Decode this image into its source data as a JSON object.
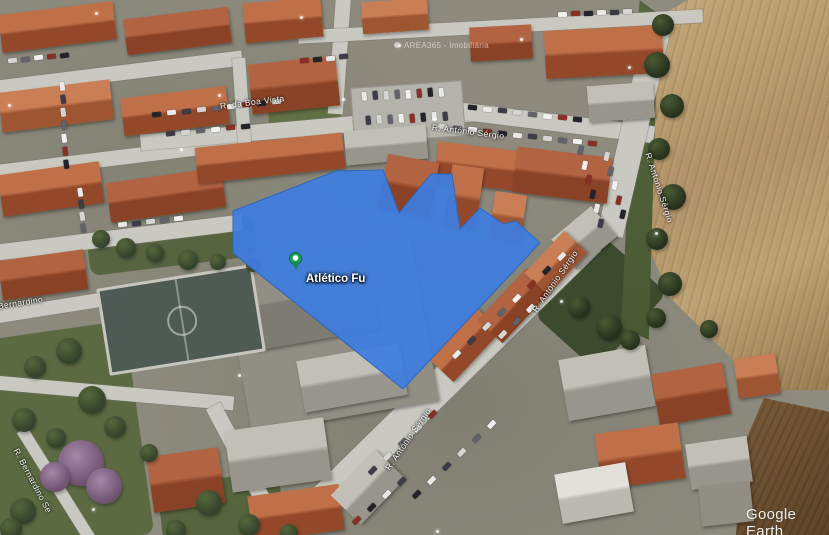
{
  "app": {
    "watermark": "Google Earth"
  },
  "attribution_label": {
    "text": "AREA365 - Imobiliária"
  },
  "marker": {
    "label": "Atlético Fu",
    "pin_color": "#1ca05f",
    "x": 296,
    "y": 272
  },
  "overlay": {
    "color": "#3d7de0",
    "stroke": "#2f66c0",
    "opacity": 0.93,
    "points": "233,211 336,171 383,170 399,213 431,174 452,174 460,229 480,208 503,224 516,221 540,243 403,389 233,253"
  },
  "street_labels": [
    {
      "text": "R. da Boa Vista",
      "x": 220,
      "y": 101,
      "rot": -7
    },
    {
      "text": "R. António Sérgio",
      "x": 432,
      "y": 122,
      "rot": 7
    },
    {
      "text": "R. António Sérgio",
      "x": 648,
      "y": 148,
      "rot": 72
    },
    {
      "text": "R. António Sérgio",
      "x": 534,
      "y": 306,
      "rot": -55
    },
    {
      "text": "R. António Sérgio",
      "x": 387,
      "y": 464,
      "rot": -55
    },
    {
      "text": "R. Bernardino",
      "x": -14,
      "y": 303,
      "rot": -9
    },
    {
      "text": "R. Bernardino Se",
      "x": 16,
      "y": 444,
      "rot": 62
    }
  ],
  "colors": {
    "parcel_blue": "#3d7de0",
    "roof_orange": "#b26442",
    "road_gray": "#c9c9c1",
    "field_tan": "#b29268",
    "pin_green": "#1ca05f"
  }
}
